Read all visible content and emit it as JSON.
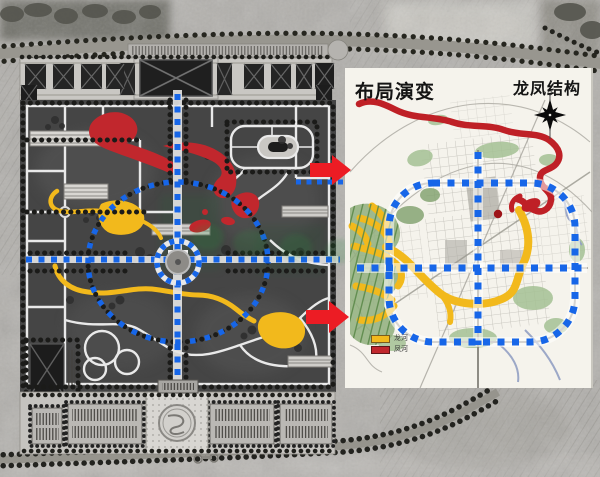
{
  "right_panel": {
    "title": "布局演变",
    "structure_label": "龙凤结构",
    "legend": [
      {
        "label": "龙河",
        "swatch_color": "#F2B91C"
      },
      {
        "label": "凤河",
        "swatch_color": "#C1272D"
      }
    ]
  },
  "icons": {
    "compass": "compass-north-icon",
    "arrows": "red-arrow-right-icon"
  },
  "colors": {
    "structure_blue": "#1766E8",
    "dragon_river_yellow": "#F2B91C",
    "phoenix_river_red": "#C1272D",
    "arrow_red": "#EC1C24",
    "panel_paper": "#F5F3EC",
    "plan_dark": "#474747",
    "aerial_gray": "#B2B0AC"
  }
}
